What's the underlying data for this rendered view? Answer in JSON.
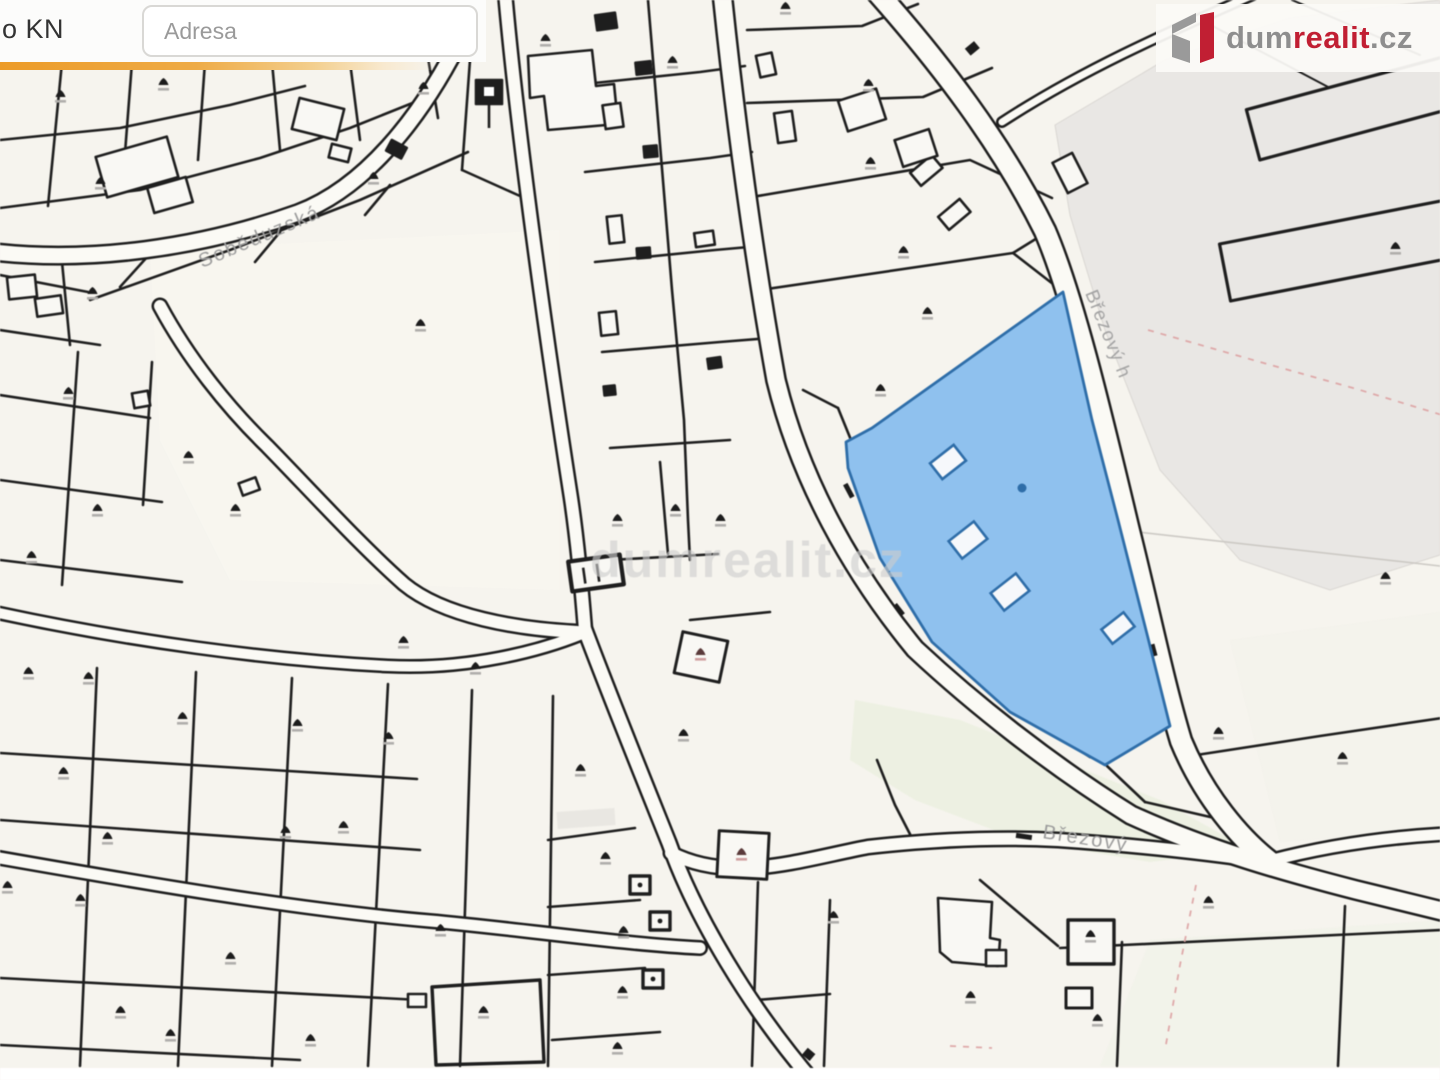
{
  "header": {
    "layer_label": "o KN",
    "address_placeholder": "Adresa"
  },
  "logo": {
    "prefix": "dum",
    "accent": "realit",
    "suffix": ".cz"
  },
  "map": {
    "watermark": "dumrealit.cz",
    "street_labels": {
      "sobeduzska": "Soběduzská",
      "brezovy_h": "Březový h",
      "brezovy": "Březový"
    },
    "colors": {
      "background": "#f6f4ee",
      "parcel_line": "#1e1e1e",
      "road_fill": "#fbfaf5",
      "highlight_fill": "#8fc1ee",
      "highlight_border": "#2e6da8",
      "accent_bar": "#ec9b28",
      "logo_red": "#c11f33",
      "forest_tint": "#e9efdd",
      "large_parcel_gray": "#e9e7e4"
    }
  }
}
